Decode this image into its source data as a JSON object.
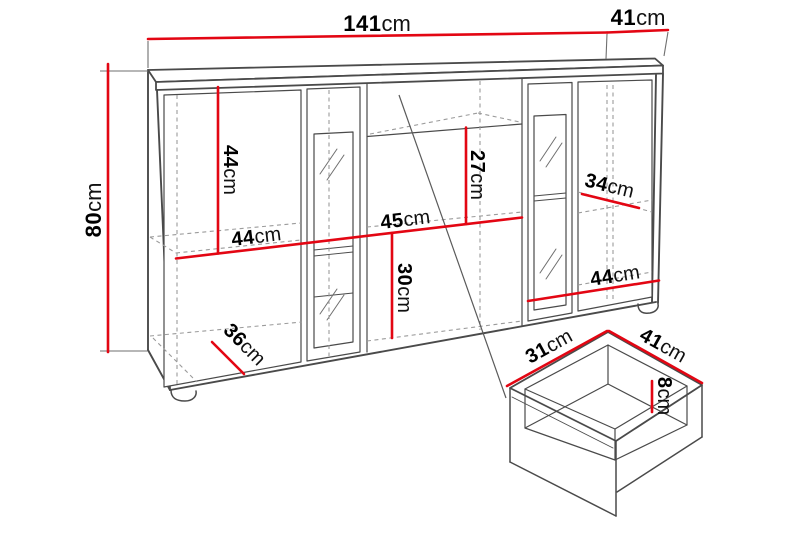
{
  "colors": {
    "dimension": "#e30613",
    "outline": "#4a4a4a",
    "thin": "#6f6f6f",
    "dashed": "#9b9b9b",
    "pointer": "#5a5a5a",
    "label": "#000000"
  },
  "diagram": {
    "cabinet": {
      "total_width": {
        "value": "141",
        "unit": "cm"
      },
      "top_depth": {
        "value": "41",
        "unit": "cm"
      },
      "total_height": {
        "value": "80",
        "unit": "cm"
      },
      "left_upper_height": {
        "value": "44",
        "unit": "cm"
      },
      "left_shelf_width": {
        "value": "44",
        "unit": "cm"
      },
      "middle_upper_height": {
        "value": "27",
        "unit": "cm"
      },
      "middle_width": {
        "value": "45",
        "unit": "cm"
      },
      "middle_lower_height": {
        "value": "30",
        "unit": "cm"
      },
      "right_shelf_depth": {
        "value": "34",
        "unit": "cm"
      },
      "right_shelf_width": {
        "value": "44",
        "unit": "cm"
      },
      "bottom_depth": {
        "value": "36",
        "unit": "cm"
      }
    },
    "drawer": {
      "depth": {
        "value": "31",
        "unit": "cm"
      },
      "width": {
        "value": "41",
        "unit": "cm"
      },
      "height": {
        "value": "8",
        "unit": "cm"
      }
    }
  }
}
